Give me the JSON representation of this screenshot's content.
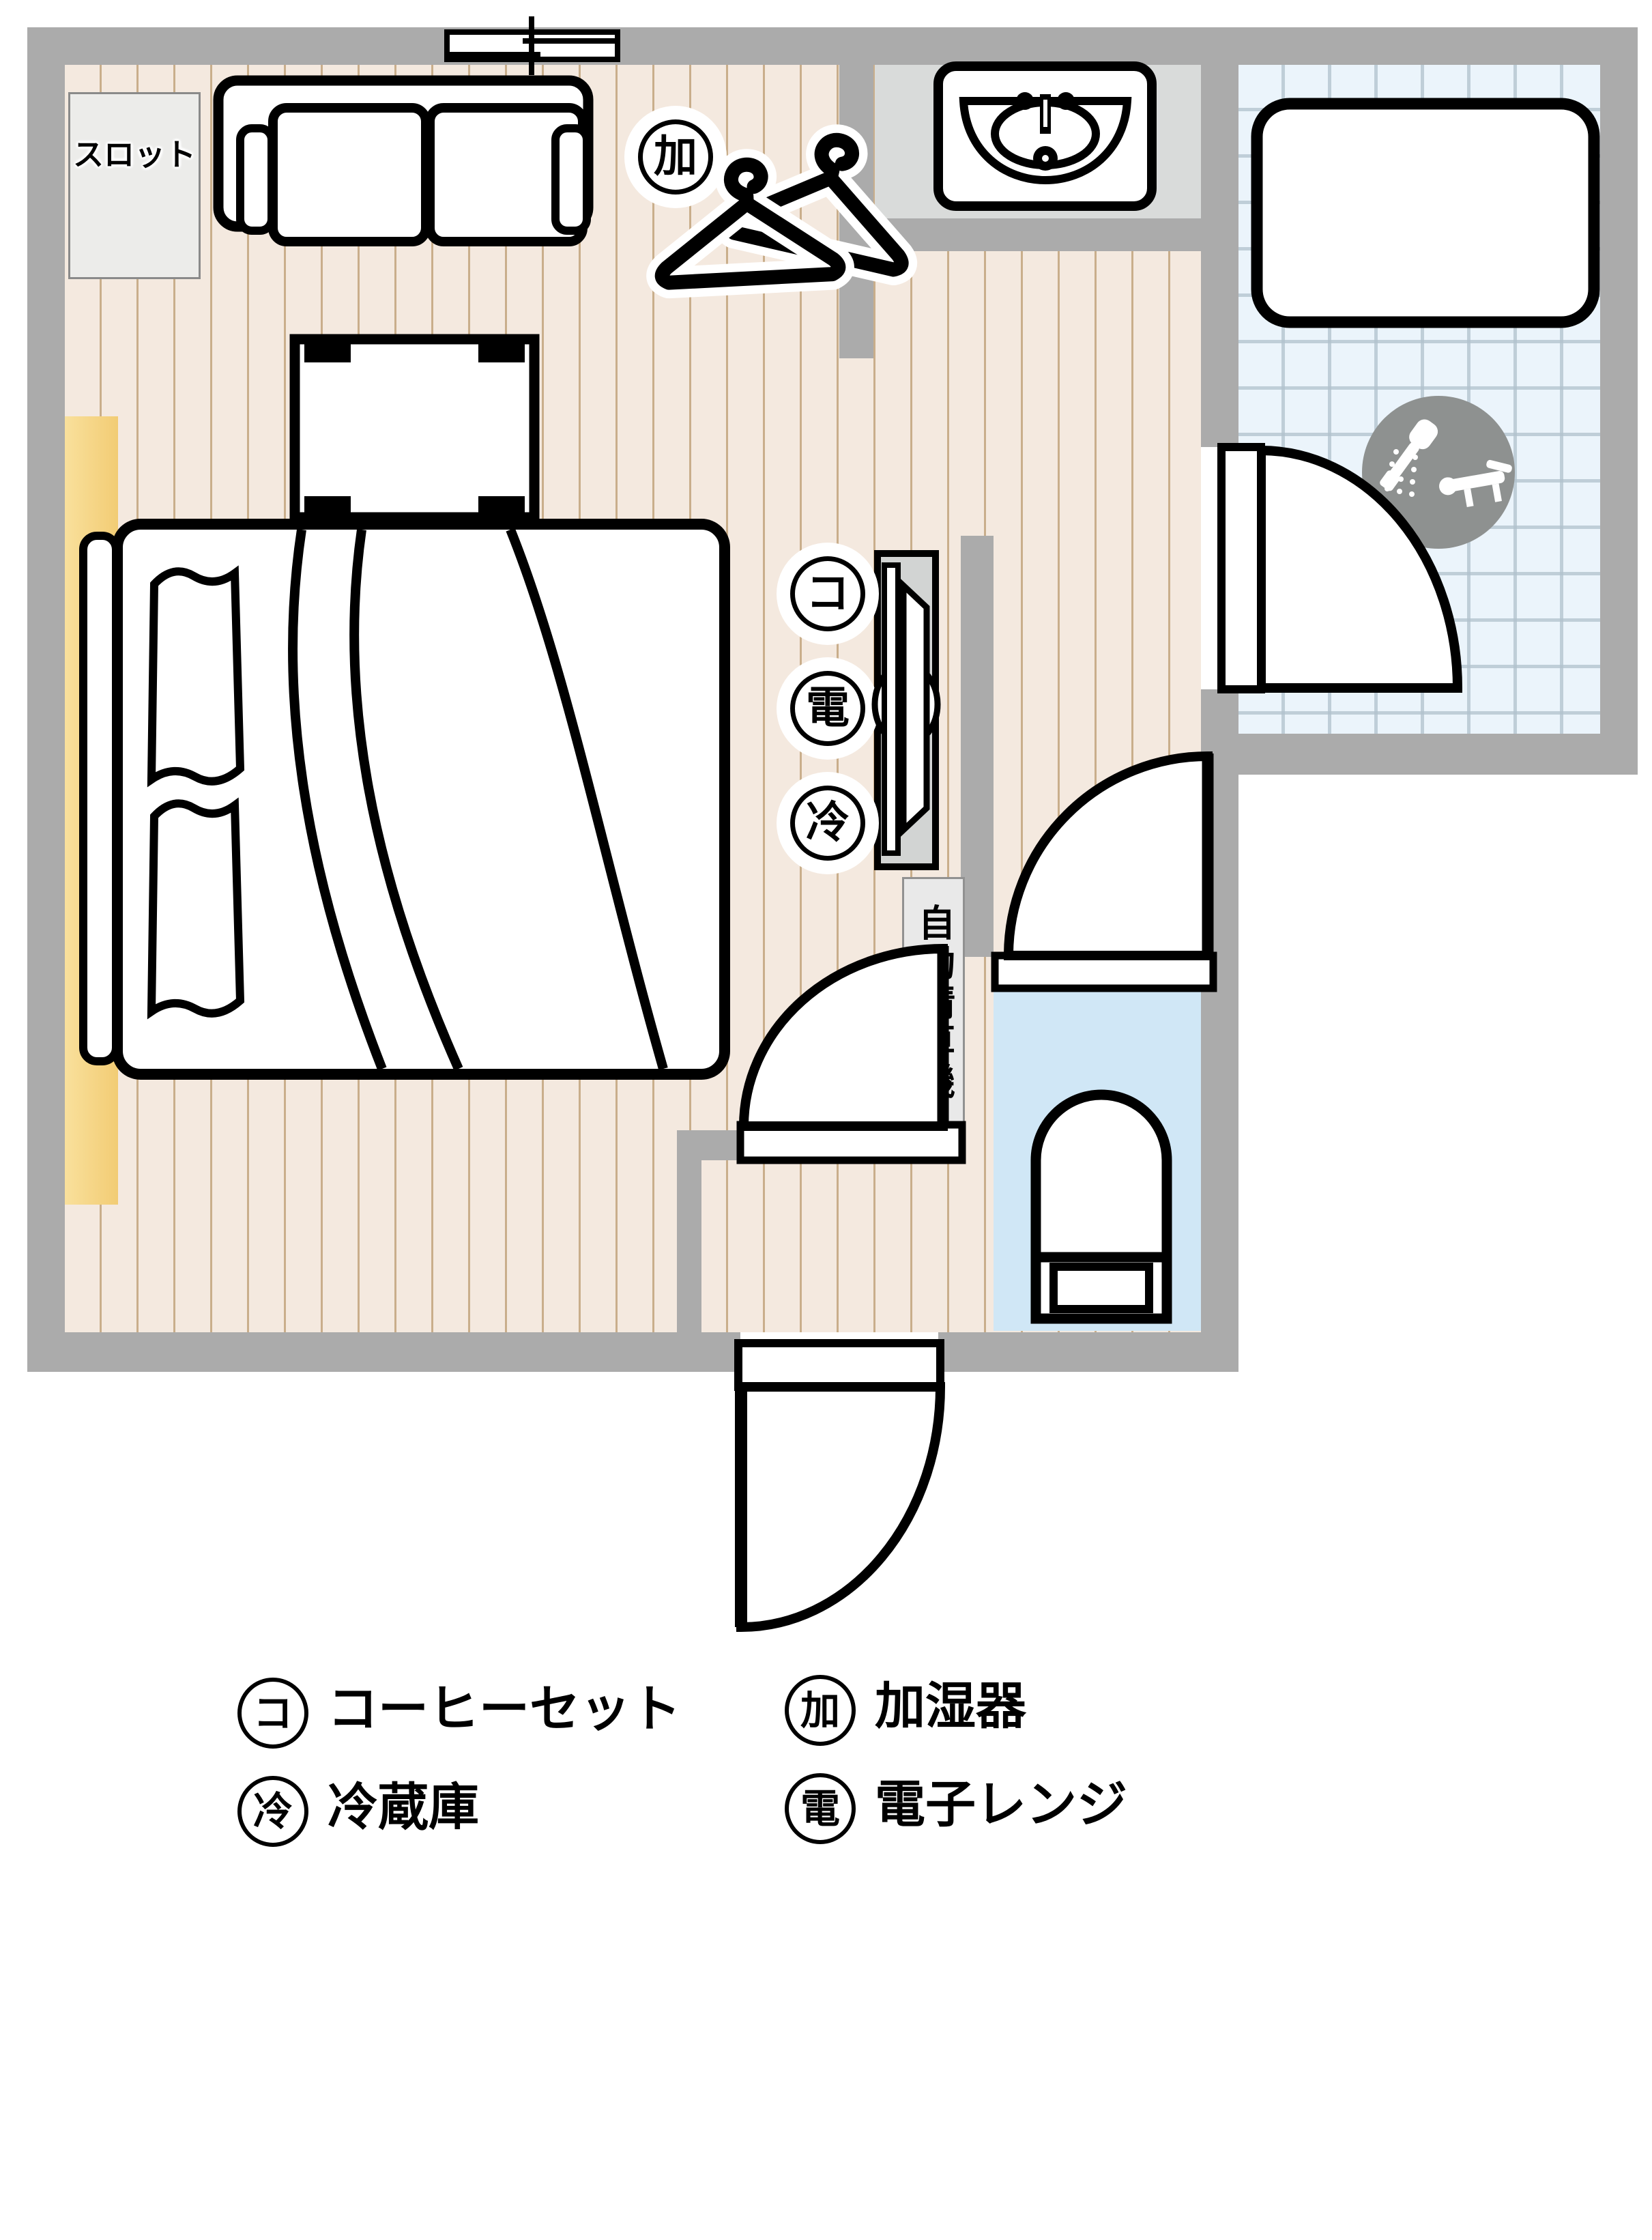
{
  "plan": {
    "slot_label": "スロット",
    "checkout_label": "自動精算機",
    "markers": {
      "humidifier": "加",
      "coffee": "コ",
      "microwave": "電",
      "fridge": "冷"
    }
  },
  "legend": [
    {
      "symbol": "コ",
      "label": "コーヒーセット"
    },
    {
      "symbol": "加",
      "label": "加湿器"
    },
    {
      "symbol": "冷",
      "label": "冷蔵庫"
    },
    {
      "symbol": "電",
      "label": "電子レンジ"
    }
  ],
  "colors": {
    "wall": "#ababab",
    "wood_floor": "#f4e9df",
    "wood_stripe": "#c9ae8b",
    "tile_floor": "#ebf4fb",
    "toilet_floor": "#d0e7f6",
    "sink_counter": "#d9dbda",
    "curtain_yellow": "#f6d68c",
    "cabinet_gray": "#d2d4d3",
    "shower_badge_gray": "#8e9190",
    "outline": "#000000"
  }
}
